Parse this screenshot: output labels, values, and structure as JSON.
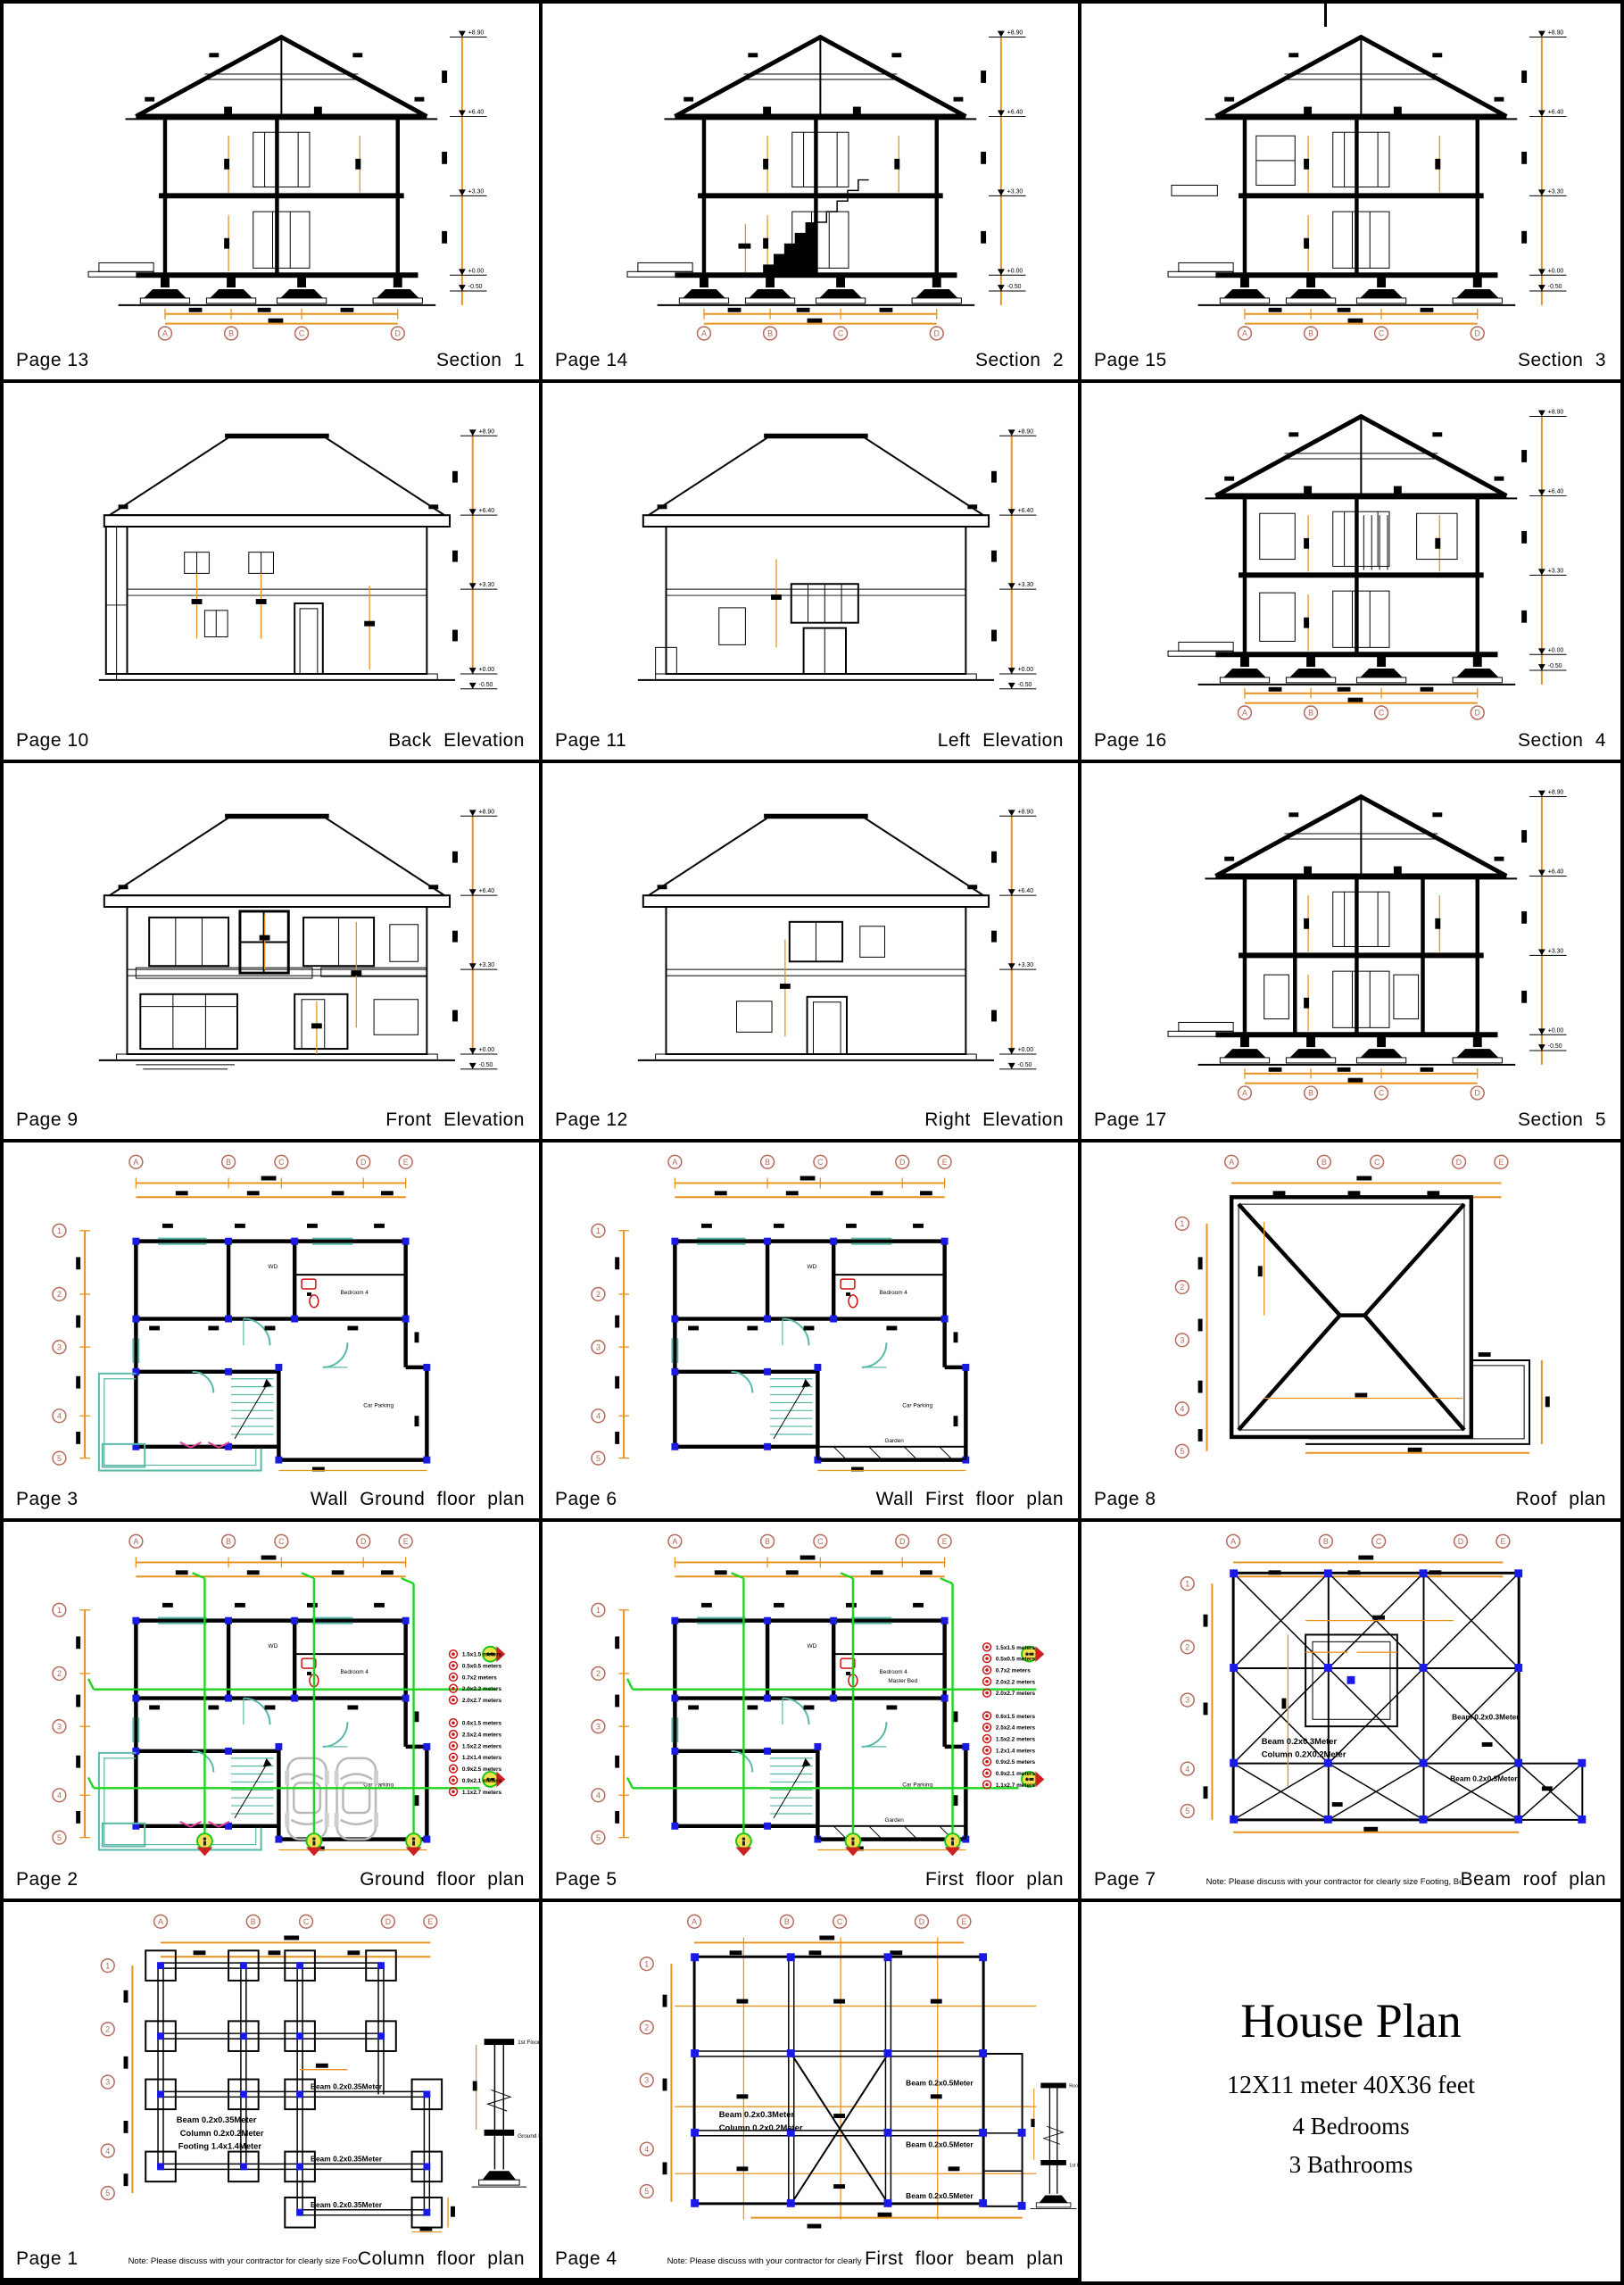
{
  "document": {
    "background": "#ffffff",
    "border_color": "#000000"
  },
  "grid": {
    "cols": [
      "A",
      "B",
      "C",
      "D",
      "E"
    ],
    "rows": [
      "1",
      "2",
      "3",
      "4",
      "5"
    ]
  },
  "levels": [
    "+8.90",
    "+6.40",
    "+3.30",
    "+0.00",
    "-0.50"
  ],
  "cells": [
    {
      "page": "Page 13",
      "title": "Section 1"
    },
    {
      "page": "Page 14",
      "title": "Section 2"
    },
    {
      "page": "Page 15",
      "title": "Section 3"
    },
    {
      "page": "Page 10",
      "title": "Back Elevation"
    },
    {
      "page": "Page 11",
      "title": "Left Elevation"
    },
    {
      "page": "Page 16",
      "title": "Section 4"
    },
    {
      "page": "Page 9",
      "title": "Front Elevation"
    },
    {
      "page": "Page 12",
      "title": "Right Elevation"
    },
    {
      "page": "Page 17",
      "title": "Section 5"
    },
    {
      "page": "Page 3",
      "title": "Wall Ground floor plan"
    },
    {
      "page": "Page 6",
      "title": "Wall First floor plan"
    },
    {
      "page": "Page 8",
      "title": "Roof plan"
    },
    {
      "page": "Page 2",
      "title": "Ground floor plan"
    },
    {
      "page": "Page 5",
      "title": "First floor plan"
    },
    {
      "page": "Page 7",
      "title": "Beam roof plan",
      "note": "Note: Please discuss with your contractor for clearly size Footing, Beam, Column"
    },
    {
      "page": "Page 1",
      "title": "Column floor plan",
      "note": "Note: Please discuss with your contractor for clearly size Footing, Beam, Column"
    },
    {
      "page": "Page 4",
      "title": "First floor beam plan",
      "note": "Note: Please discuss with your contractor for clearly size Footing, Beam, Column"
    }
  ],
  "house_plan": {
    "title": "House Plan",
    "size": "12X11 meter 40X36 feet",
    "bedrooms": "4 Bedrooms",
    "bathrooms": "3 Bathrooms"
  },
  "structure_labels": {
    "beam_035": "Beam 0.2x0.35Meter",
    "beam_03": "Beam 0.2x0.3Meter",
    "beam_05": "Beam 0.2x0.5Meter",
    "column_02": "Column 0.2x0.2Meter",
    "column_02x": "Column 0.2X0.2Meter",
    "footing_14": "Footing 1.4x1.4Meter"
  },
  "detail_labels": {
    "first_floor": "1st Floor",
    "ground_floor": "Ground Floor",
    "roof_floor": "Roof Floor"
  },
  "room_labels": {
    "wd": "WD",
    "bedroom4": "Bedroom 4",
    "master_bed": "Master Bed",
    "car_parking": "Car Parking",
    "garden": "Garden"
  },
  "legend": {
    "windows": [
      "1.5x1.5 meters",
      "0.5x0.5 meters",
      "0.7x2 meters",
      "2.0x2.2 meters",
      "2.0x2.7 meters"
    ],
    "doors": [
      "0.6x1.5 meters",
      "2.5x2.4 meters",
      "1.5x2.2 meters",
      "1.2x1.4 meters",
      "0.9x2.5 meters",
      "0.9x2.1 meters",
      "1.1x2.7 meters"
    ]
  },
  "colors": {
    "dimension_orange": "#E8921E",
    "grid_bubble": "#b5695a",
    "column_blue": "#1a1ae6",
    "fixture_teal": "#57b8a8",
    "section_green": "#1ed41e",
    "legend_red": "#cc1111",
    "car_gray": "#b9b9b9",
    "accent_pink": "#e0409a"
  }
}
